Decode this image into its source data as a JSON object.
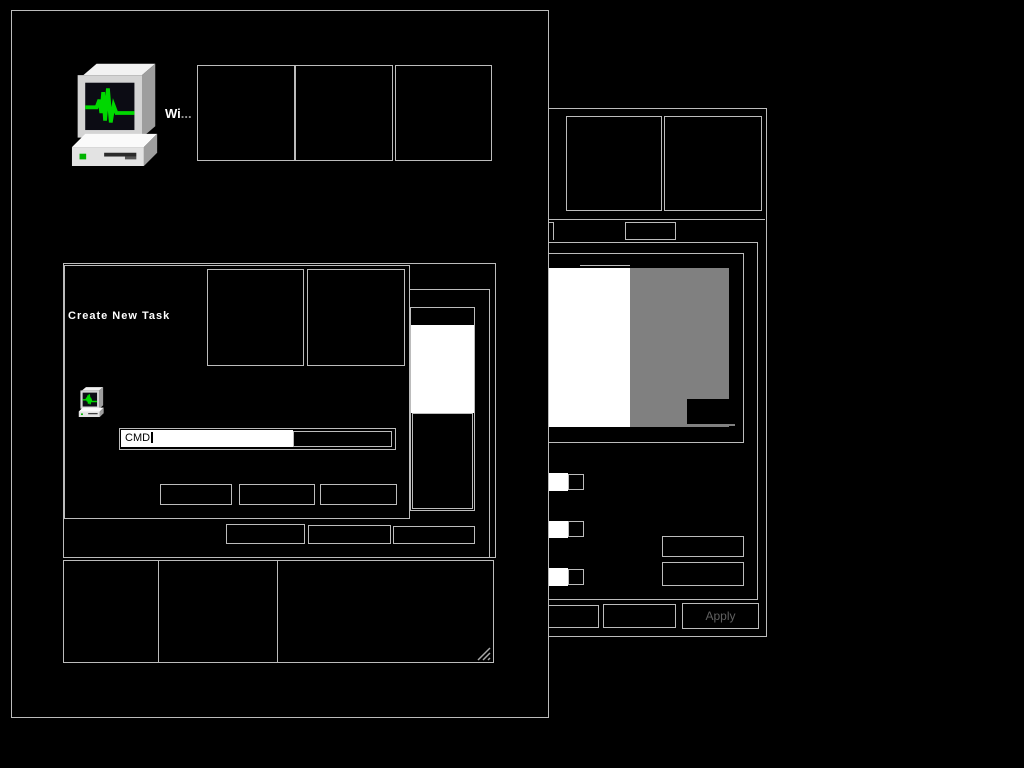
{
  "colors": {
    "desktop_bg": "#000000",
    "window_bg": "#000000",
    "border": "#bcbcbc",
    "preview_white": "#ffffff",
    "preview_gray": "#808080",
    "apply_text_disabled": "#606060",
    "icon_screen_green": "#00d800"
  },
  "taskmanager_window": {
    "icon": "task-manager-computer-icon",
    "title_visible": "Wi",
    "title_ellipsis": "...",
    "titlebar_buttons": [
      "",
      "",
      ""
    ],
    "action_buttons": [
      "",
      "",
      ""
    ],
    "status_panes": [
      "",
      "",
      ""
    ]
  },
  "create_new_task_dialog": {
    "title": "Create New Task",
    "icon": "task-manager-computer-icon",
    "titlebar_buttons": [
      "",
      ""
    ],
    "input": {
      "value": "CMD"
    },
    "buttons": [
      "",
      "",
      ""
    ]
  },
  "properties_window": {
    "titlebar_buttons": [
      "",
      ""
    ],
    "tabs": [
      "",
      ""
    ],
    "side_buttons": [
      "",
      ""
    ],
    "bottom_buttons": [
      "",
      "",
      "Apply"
    ]
  }
}
